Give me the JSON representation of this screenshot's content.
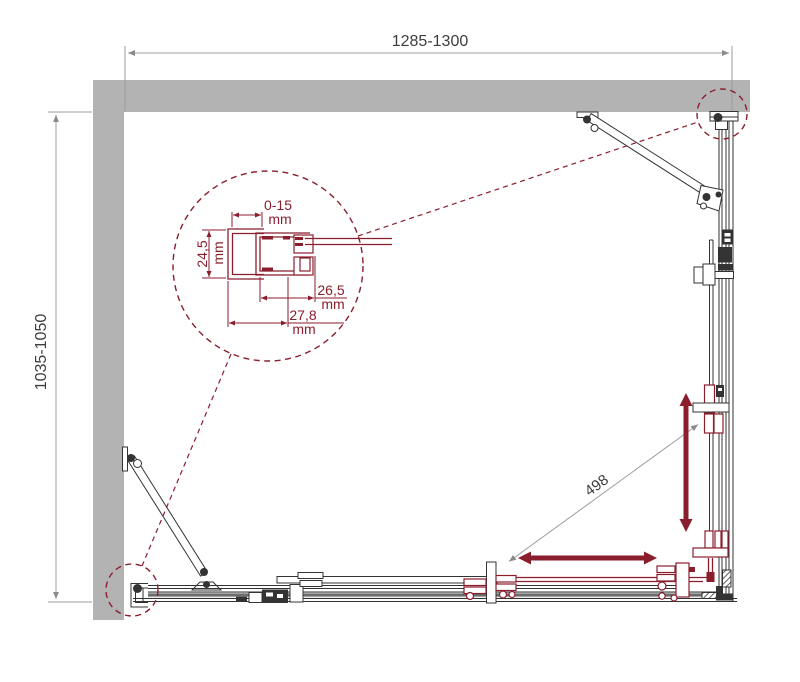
{
  "colors": {
    "wall": "#b3b3b3",
    "line": "#333333",
    "dim": "#9c9c9c",
    "arrow": "#8a8a8a",
    "text": "#3d3d3d",
    "accent": "#8b1e2d",
    "glass": "#a4a4a4"
  },
  "dimensions": {
    "width": {
      "label": "1285-1300"
    },
    "depth": {
      "label": "1035-1050"
    },
    "entry_width": {
      "label": "498"
    }
  },
  "detail": {
    "wall_profile_adjustment": {
      "value": "0-15",
      "unit": "mm"
    },
    "profile_depth": {
      "value": "24,5",
      "unit": "mm"
    },
    "profile_offset_inner": {
      "value": "26,5",
      "unit": "mm"
    },
    "profile_offset_outer": {
      "value": "27,8",
      "unit": "mm"
    }
  }
}
